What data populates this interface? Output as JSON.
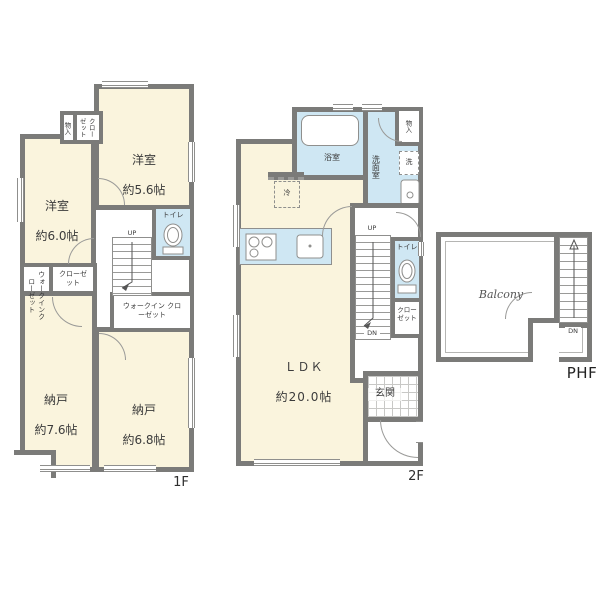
{
  "palette": {
    "wall": "#7b7b79",
    "room_fill": "#faf4dd",
    "wet_fill": "#cfe7f3",
    "line": "#8f8f8d",
    "text": "#3b3b3b"
  },
  "floor1": {
    "floor_label": "1F",
    "yoshitsu_56": {
      "name": "洋室",
      "size": "約5.6帖"
    },
    "yoshitsu_60": {
      "name": "洋室",
      "size": "約6.0帖"
    },
    "nando_76": {
      "name": "納戸",
      "size": "約7.6帖"
    },
    "nando_68": {
      "name": "納戸",
      "size": "約6.8帖"
    },
    "closet_top": "クローゼット",
    "storage_small": "物入",
    "wic_left": "ウォークインクローゼット",
    "closet_mid": "クローゼット",
    "wic_center": "ウォークイン クローゼット",
    "toilet": "トイレ",
    "stairs_up": "UP"
  },
  "floor2": {
    "floor_label": "2F",
    "ldk": {
      "name": "ＬＤＫ",
      "size": "約20.0帖"
    },
    "bath": "浴室",
    "washroom": "洗面室",
    "storage": "物入",
    "washer": "洗",
    "fridge": "冷",
    "toilet": "トイレ",
    "closet": "クローゼット",
    "genkan": "玄関",
    "stairs_up": "UP",
    "stairs_dn": "DN"
  },
  "phf": {
    "floor_label": "PHF",
    "balcony": "Balcony",
    "stairs_dn": "DN"
  }
}
